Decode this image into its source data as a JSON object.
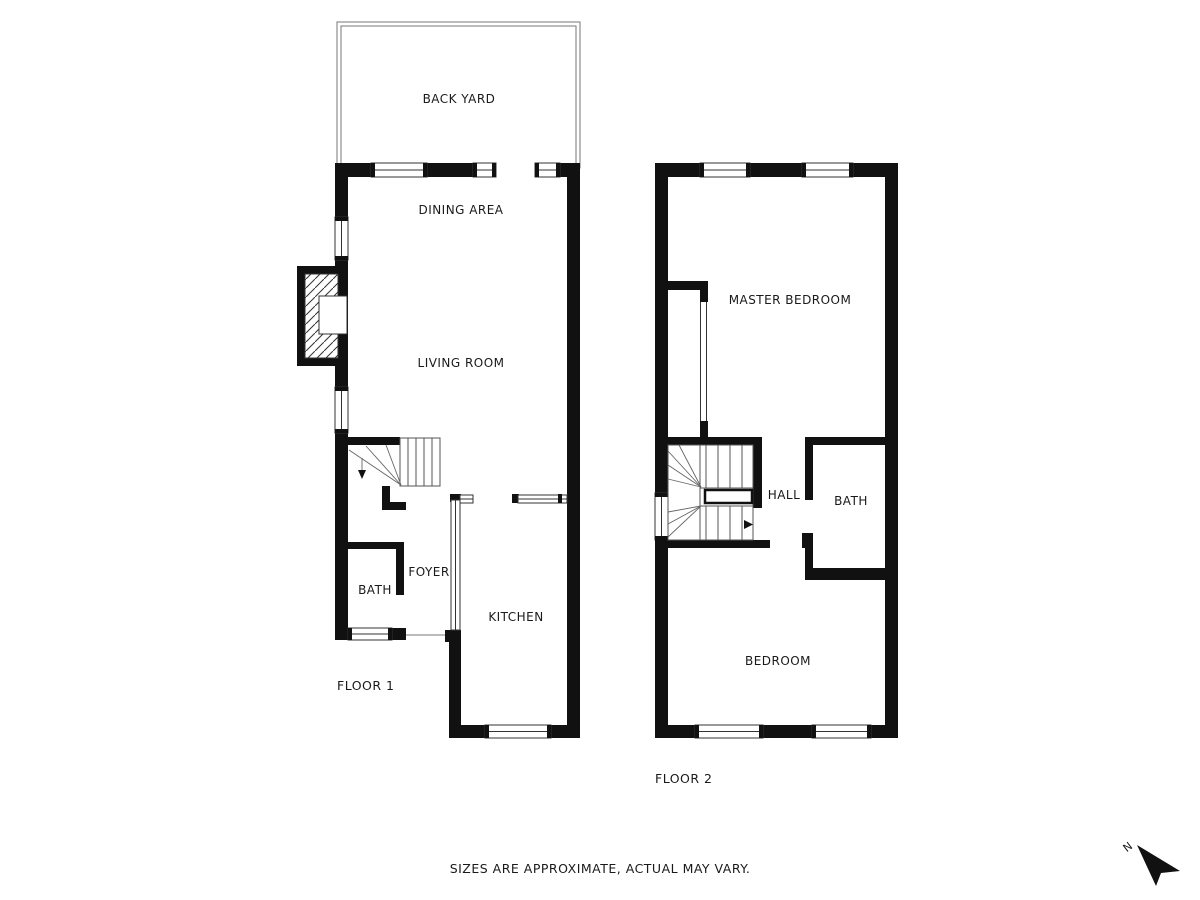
{
  "footer": {
    "disclaimer": "SIZES ARE APPROXIMATE, ACTUAL MAY VARY."
  },
  "compass": {
    "north_label": "N"
  },
  "floor1": {
    "floor_label": "FLOOR 1",
    "rooms": {
      "back_yard": "BACK YARD",
      "dining_area": "DINING AREA",
      "living_room": "LIVING ROOM",
      "foyer": "FOYER",
      "bath": "BATH",
      "kitchen": "KITCHEN"
    }
  },
  "floor2": {
    "floor_label": "FLOOR 2",
    "rooms": {
      "master_bedroom": "MASTER BEDROOM",
      "hall": "HALL",
      "bath": "BATH",
      "bedroom": "BEDROOM"
    }
  },
  "colors": {
    "wall": "#111111",
    "background": "#ffffff",
    "thin_line": "#555555"
  }
}
